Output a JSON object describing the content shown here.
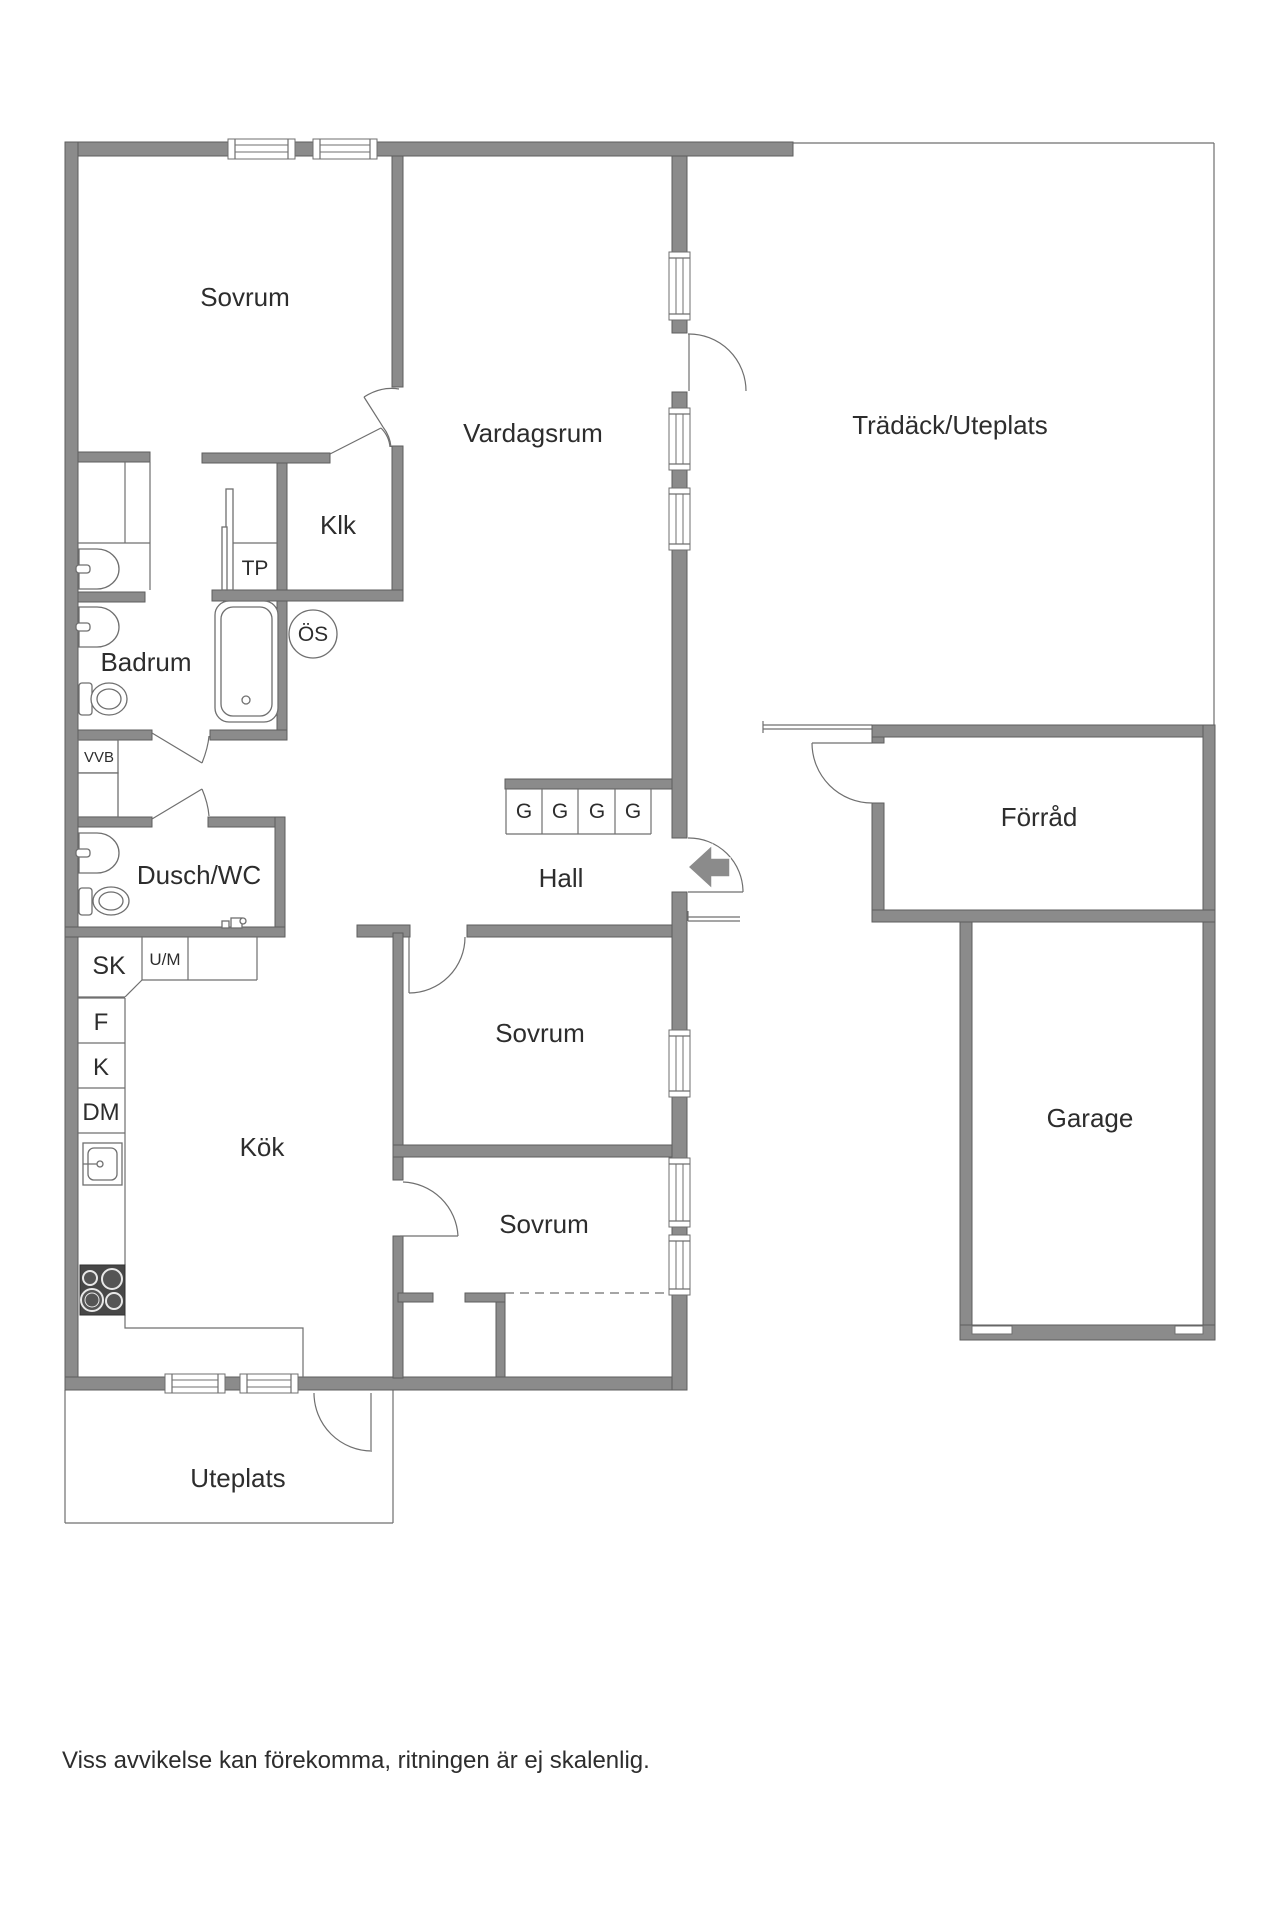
{
  "title": "Floor plan",
  "rooms": {
    "sovrum_nw": "Sovrum",
    "vardagsrum": "Vardagsrum",
    "tradack": "Trädäck/Uteplats",
    "klk": "Klk",
    "tp": "TP",
    "os": "ÖS",
    "badrum": "Badrum",
    "vvb": "VVB",
    "dusch_wc": "Dusch/WC",
    "hall": "Hall",
    "forrad": "Förråd",
    "sk": "SK",
    "um": "U/M",
    "f": "F",
    "k": "K",
    "dm": "DM",
    "kok": "Kök",
    "sovrum_mid": "Sovrum",
    "sovrum_s": "Sovrum",
    "garage": "Garage",
    "uteplats": "Uteplats"
  },
  "wardrobes": {
    "g1": "G",
    "g2": "G",
    "g3": "G",
    "g4": "G"
  },
  "footer": {
    "disclaimer": "Viss avvikelse kan förekomma, ritningen är ej skalenlig."
  },
  "colors": {
    "wall": "#8b8b8b",
    "wall_border": "#5e5e5e",
    "thin_line": "#6f6f6f",
    "text": "#2d2d2d",
    "stove": "#474747",
    "background": "#ffffff"
  }
}
